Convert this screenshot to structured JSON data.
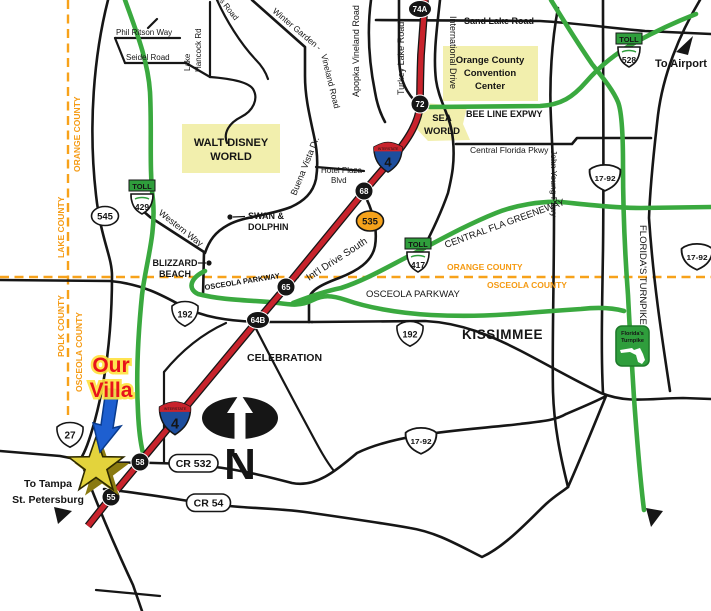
{
  "colors": {
    "interstate_red": "#c8232c",
    "toll_green": "#3aa93f",
    "county_orange": "#f59a12",
    "highlight_yellow": "#f2efad",
    "villa_red": "#e8131b",
    "arrow_blue": "#1e5fd0",
    "star_gold": "#e3d33c",
    "shield_orange": "#f6a21b",
    "interstate_blue": "#1d4e9e"
  },
  "counties": {
    "orange_v": "ORANGE COUNTY",
    "lake_v": "LAKE COUNTY",
    "polk_v": "POLK COUNTY",
    "osceola_v": "OSCEOLA COUNTY",
    "orange_h": "ORANGE COUNTY",
    "osceola_h": "OSCEOLA COUNTY"
  },
  "cities": {
    "kissimmee": "KISSIMMEE",
    "celebration": "CELEBRATION"
  },
  "areas": {
    "wdw1": "WALT DISNEY",
    "wdw2": "WORLD",
    "occc1": "Orange County",
    "occc2": "Convention",
    "occc3": "Center",
    "sea1": "SEA",
    "sea2": "WORLD"
  },
  "pois": {
    "swan1": "SWAN &",
    "swan2": "DOLPHIN",
    "blizzard1": "BLIZZARD",
    "blizzard2": "BEACH"
  },
  "roads": {
    "phil_ritson": "Phil Ritson Way",
    "seidel": "Seidel Road",
    "lake_hancock1": "Lake",
    "lake_hancock2": "Hancock Rd",
    "reams": "Reams Road",
    "winter_garden": "Winter Garden -",
    "vineland": "Vineland Road",
    "sand_lake": "Sand Lake Road",
    "apopka_vineland": "Apopka Vineland Road",
    "turkey_lake": "Turkey Lake Road",
    "international_drive": "International Drive",
    "bee_line": "BEE LINE EXPWY",
    "central_florida": "Central Florida Pkwy",
    "john_young": "John Young Pkwy",
    "hotel_plaza1": "Hotel Plaza",
    "hotel_plaza2": "Blvd",
    "western_way": "Western Way",
    "buena_vista": "Buena Vista Dr.",
    "osceola_pkwy_diag": "OSCEOLA PARKWAY",
    "osceola_pkwy": "OSCEOLA PARKWAY",
    "intl_drive_south": "Int'l Drive South",
    "greeneway": "CENTRAL FLA GREENEWAY",
    "floridas_turnpike": "FLORIDA'S TURNPIKE"
  },
  "shields": {
    "toll": "TOLL",
    "interstate": "INTERSTATE",
    "i4": "4",
    "sr545": "545",
    "sr429": "429",
    "sr417": "417",
    "sr528": "528",
    "sr535": "535",
    "us192": "192",
    "us27": "27",
    "us1792": "17-92",
    "cr532": "CR 532",
    "cr54": "CR 54",
    "turnpike_logo1": "Florida's",
    "turnpike_logo2": "Turnpike"
  },
  "exits": {
    "e74a": "74A",
    "e72": "72",
    "e68": "68",
    "e65": "65",
    "e64b": "64B",
    "e58": "58",
    "e55": "55"
  },
  "annotations": {
    "villa1": "Our",
    "villa2": "Villa",
    "tampa1": "To Tampa",
    "tampa2": "St. Petersburg",
    "airport": "To Airport",
    "north": "N"
  }
}
